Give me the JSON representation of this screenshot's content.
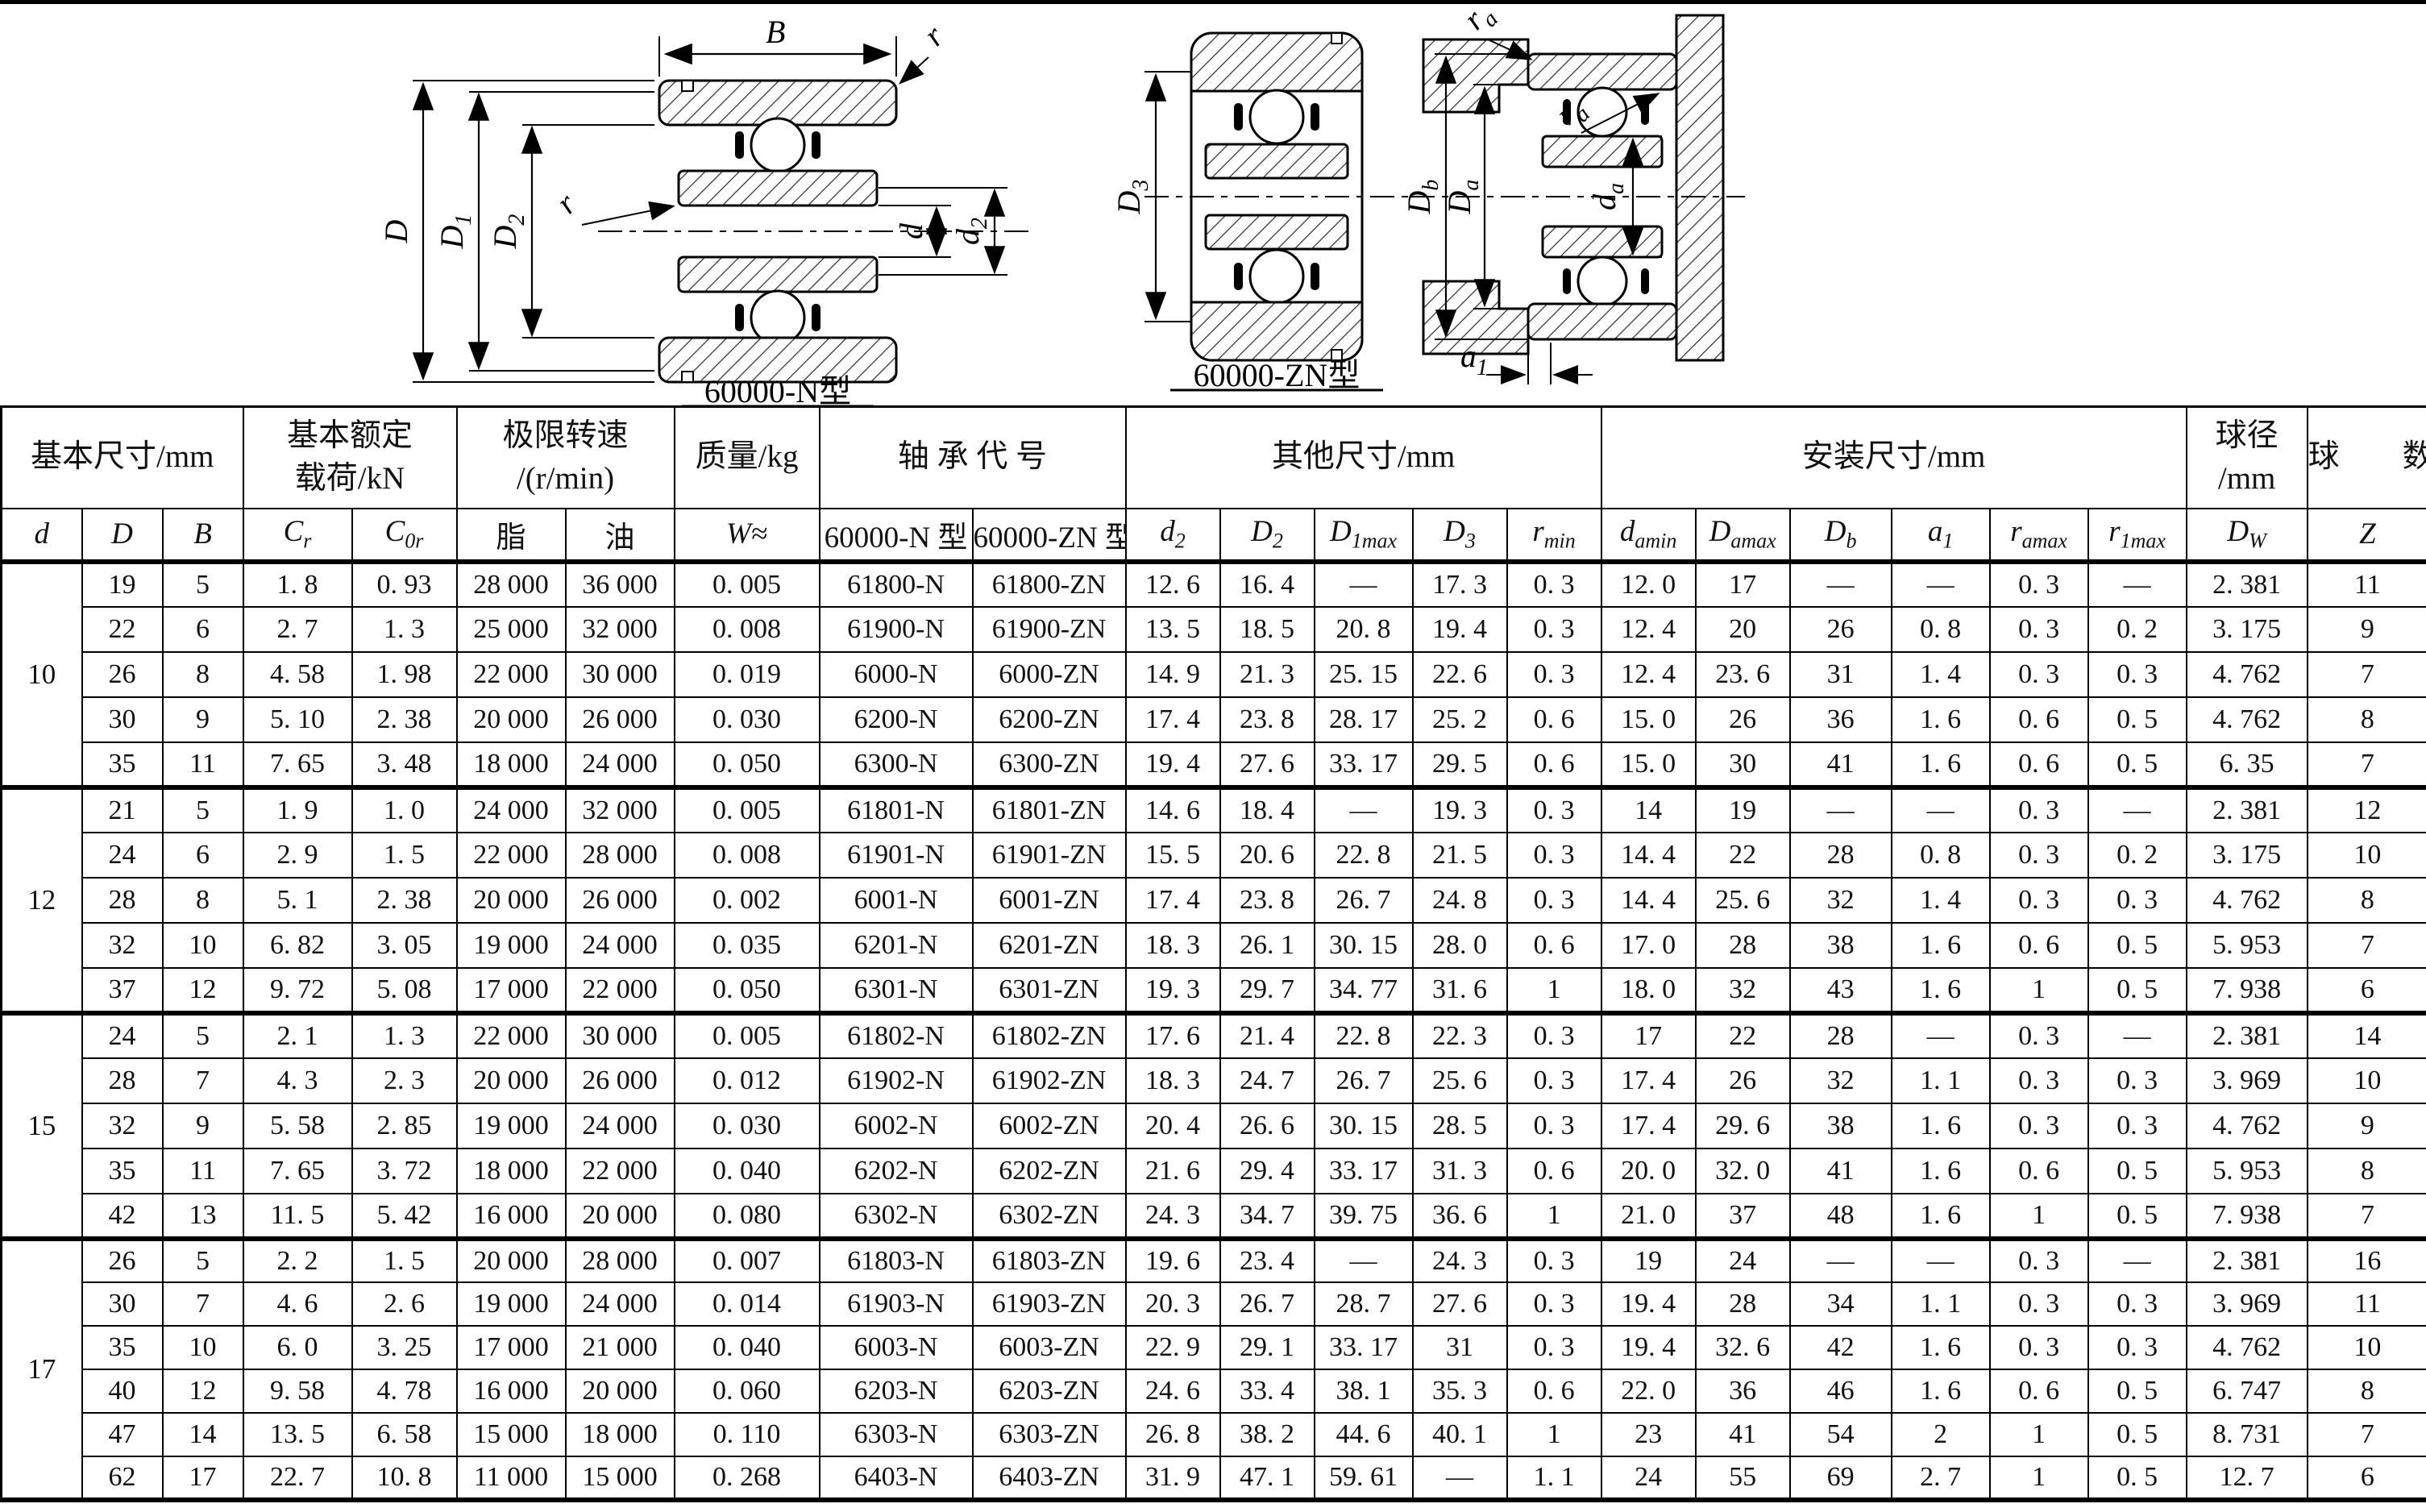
{
  "diagrams": {
    "n": {
      "label": "60000-N型",
      "B": "B",
      "r": "r",
      "D": {
        "m": "D",
        "s": ""
      },
      "D1": {
        "m": "D",
        "s": "1"
      },
      "D2": {
        "m": "D",
        "s": "2"
      },
      "d": {
        "m": "d",
        "s": ""
      },
      "d2": {
        "m": "d",
        "s": "2"
      }
    },
    "zn": {
      "label": "60000-ZN型",
      "D3": {
        "m": "D",
        "s": "3"
      }
    },
    "mount": {
      "Db": {
        "m": "D",
        "s": "b"
      },
      "Da": {
        "m": "D",
        "s": "a"
      },
      "da": {
        "m": "d",
        "s": "a"
      },
      "a1": {
        "m": "a",
        "s": "1"
      },
      "ra": {
        "m": "r",
        "s": "a"
      }
    }
  },
  "table": {
    "group_headers": [
      {
        "lines": [
          "基本尺寸/mm"
        ],
        "colspan": 3
      },
      {
        "lines": [
          "基本额定",
          "载荷/kN"
        ],
        "colspan": 2
      },
      {
        "lines": [
          "极限转速",
          "/(r/min)"
        ],
        "colspan": 2
      },
      {
        "lines": [
          "质量/kg"
        ],
        "colspan": 1
      },
      {
        "lines": [
          "轴 承 代 号"
        ],
        "colspan": 2
      },
      {
        "lines": [
          "其他尺寸/mm"
        ],
        "colspan": 5
      },
      {
        "lines": [
          "安装尺寸/mm"
        ],
        "colspan": 6
      },
      {
        "lines": [
          "球径",
          "/mm"
        ],
        "colspan": 1
      },
      {
        "lines": [
          "球　　数"
        ],
        "colspan": 1
      }
    ],
    "sub_headers": [
      {
        "m": "d",
        "it": true
      },
      {
        "m": "D",
        "it": true
      },
      {
        "m": "B",
        "it": true
      },
      {
        "m": "C",
        "s": "r",
        "it": true
      },
      {
        "m": "C",
        "s": "0r",
        "it": true
      },
      {
        "m": "脂"
      },
      {
        "m": "油"
      },
      {
        "m": "W≈",
        "it": true
      },
      {
        "m": "60000-N 型"
      },
      {
        "m": "60000-ZN 型"
      },
      {
        "m": "d",
        "s": "2",
        "it": true
      },
      {
        "m": "D",
        "s": "2",
        "it": true
      },
      {
        "m": "D",
        "s": "1max",
        "it": true
      },
      {
        "m": "D",
        "s": "3",
        "it": true
      },
      {
        "m": "r",
        "s": "min",
        "it": true
      },
      {
        "m": "d",
        "s": "amin",
        "it": true
      },
      {
        "m": "D",
        "s": "amax",
        "it": true
      },
      {
        "m": "D",
        "s": "b",
        "it": true
      },
      {
        "m": "a",
        "s": "1",
        "it": true
      },
      {
        "m": "r",
        "s": "amax",
        "it": true
      },
      {
        "m": "r",
        "s": "1max",
        "it": true
      },
      {
        "m": "D",
        "s": "W",
        "it": true
      },
      {
        "m": "Z",
        "it": true
      }
    ],
    "groups": [
      {
        "d": "10",
        "rows": [
          [
            "19",
            "5",
            "1. 8",
            "0. 93",
            "28 000",
            "36 000",
            "0. 005",
            "61800-N",
            "61800-ZN",
            "12. 6",
            "16. 4",
            "—",
            "17. 3",
            "0. 3",
            "12. 0",
            "17",
            "—",
            "—",
            "0. 3",
            "—",
            "2. 381",
            "11"
          ],
          [
            "22",
            "6",
            "2. 7",
            "1. 3",
            "25 000",
            "32 000",
            "0. 008",
            "61900-N",
            "61900-ZN",
            "13. 5",
            "18. 5",
            "20. 8",
            "19. 4",
            "0. 3",
            "12. 4",
            "20",
            "26",
            "0. 8",
            "0. 3",
            "0. 2",
            "3. 175",
            "9"
          ],
          [
            "26",
            "8",
            "4. 58",
            "1. 98",
            "22 000",
            "30 000",
            "0. 019",
            "6000-N",
            "6000-ZN",
            "14. 9",
            "21. 3",
            "25. 15",
            "22. 6",
            "0. 3",
            "12. 4",
            "23. 6",
            "31",
            "1. 4",
            "0. 3",
            "0. 3",
            "4. 762",
            "7"
          ],
          [
            "30",
            "9",
            "5. 10",
            "2. 38",
            "20 000",
            "26 000",
            "0. 030",
            "6200-N",
            "6200-ZN",
            "17. 4",
            "23. 8",
            "28. 17",
            "25. 2",
            "0. 6",
            "15. 0",
            "26",
            "36",
            "1. 6",
            "0. 6",
            "0. 5",
            "4. 762",
            "8"
          ],
          [
            "35",
            "11",
            "7. 65",
            "3. 48",
            "18 000",
            "24 000",
            "0. 050",
            "6300-N",
            "6300-ZN",
            "19. 4",
            "27. 6",
            "33. 17",
            "29. 5",
            "0. 6",
            "15. 0",
            "30",
            "41",
            "1. 6",
            "0. 6",
            "0. 5",
            "6. 35",
            "7"
          ]
        ]
      },
      {
        "d": "12",
        "rows": [
          [
            "21",
            "5",
            "1. 9",
            "1. 0",
            "24 000",
            "32 000",
            "0. 005",
            "61801-N",
            "61801-ZN",
            "14. 6",
            "18. 4",
            "—",
            "19. 3",
            "0. 3",
            "14",
            "19",
            "—",
            "—",
            "0. 3",
            "—",
            "2. 381",
            "12"
          ],
          [
            "24",
            "6",
            "2. 9",
            "1. 5",
            "22 000",
            "28 000",
            "0. 008",
            "61901-N",
            "61901-ZN",
            "15. 5",
            "20. 6",
            "22. 8",
            "21. 5",
            "0. 3",
            "14. 4",
            "22",
            "28",
            "0. 8",
            "0. 3",
            "0. 2",
            "3. 175",
            "10"
          ],
          [
            "28",
            "8",
            "5. 1",
            "2. 38",
            "20 000",
            "26 000",
            "0. 002",
            "6001-N",
            "6001-ZN",
            "17. 4",
            "23. 8",
            "26. 7",
            "24. 8",
            "0. 3",
            "14. 4",
            "25. 6",
            "32",
            "1. 4",
            "0. 3",
            "0. 3",
            "4. 762",
            "8"
          ],
          [
            "32",
            "10",
            "6. 82",
            "3. 05",
            "19 000",
            "24 000",
            "0. 035",
            "6201-N",
            "6201-ZN",
            "18. 3",
            "26. 1",
            "30. 15",
            "28. 0",
            "0. 6",
            "17. 0",
            "28",
            "38",
            "1. 6",
            "0. 6",
            "0. 5",
            "5. 953",
            "7"
          ],
          [
            "37",
            "12",
            "9. 72",
            "5. 08",
            "17 000",
            "22 000",
            "0. 050",
            "6301-N",
            "6301-ZN",
            "19. 3",
            "29. 7",
            "34. 77",
            "31. 6",
            "1",
            "18. 0",
            "32",
            "43",
            "1. 6",
            "1",
            "0. 5",
            "7. 938",
            "6"
          ]
        ]
      },
      {
        "d": "15",
        "rows": [
          [
            "24",
            "5",
            "2. 1",
            "1. 3",
            "22 000",
            "30 000",
            "0. 005",
            "61802-N",
            "61802-ZN",
            "17. 6",
            "21. 4",
            "22. 8",
            "22. 3",
            "0. 3",
            "17",
            "22",
            "28",
            "—",
            "0. 3",
            "—",
            "2. 381",
            "14"
          ],
          [
            "28",
            "7",
            "4. 3",
            "2. 3",
            "20 000",
            "26 000",
            "0. 012",
            "61902-N",
            "61902-ZN",
            "18. 3",
            "24. 7",
            "26. 7",
            "25. 6",
            "0. 3",
            "17. 4",
            "26",
            "32",
            "1. 1",
            "0. 3",
            "0. 3",
            "3. 969",
            "10"
          ],
          [
            "32",
            "9",
            "5. 58",
            "2. 85",
            "19 000",
            "24 000",
            "0. 030",
            "6002-N",
            "6002-ZN",
            "20. 4",
            "26. 6",
            "30. 15",
            "28. 5",
            "0. 3",
            "17. 4",
            "29. 6",
            "38",
            "1. 6",
            "0. 3",
            "0. 3",
            "4. 762",
            "9"
          ],
          [
            "35",
            "11",
            "7. 65",
            "3. 72",
            "18 000",
            "22 000",
            "0. 040",
            "6202-N",
            "6202-ZN",
            "21. 6",
            "29. 4",
            "33. 17",
            "31. 3",
            "0. 6",
            "20. 0",
            "32. 0",
            "41",
            "1. 6",
            "0. 6",
            "0. 5",
            "5. 953",
            "8"
          ],
          [
            "42",
            "13",
            "11. 5",
            "5. 42",
            "16 000",
            "20 000",
            "0. 080",
            "6302-N",
            "6302-ZN",
            "24. 3",
            "34. 7",
            "39. 75",
            "36. 6",
            "1",
            "21. 0",
            "37",
            "48",
            "1. 6",
            "1",
            "0. 5",
            "7. 938",
            "7"
          ]
        ]
      },
      {
        "d": "17",
        "rows": [
          [
            "26",
            "5",
            "2. 2",
            "1. 5",
            "20 000",
            "28 000",
            "0. 007",
            "61803-N",
            "61803-ZN",
            "19. 6",
            "23. 4",
            "—",
            "24. 3",
            "0. 3",
            "19",
            "24",
            "—",
            "—",
            "0. 3",
            "—",
            "2. 381",
            "16"
          ],
          [
            "30",
            "7",
            "4. 6",
            "2. 6",
            "19 000",
            "24 000",
            "0. 014",
            "61903-N",
            "61903-ZN",
            "20. 3",
            "26. 7",
            "28. 7",
            "27. 6",
            "0. 3",
            "19. 4",
            "28",
            "34",
            "1. 1",
            "0. 3",
            "0. 3",
            "3. 969",
            "11"
          ],
          [
            "35",
            "10",
            "6. 0",
            "3. 25",
            "17 000",
            "21 000",
            "0. 040",
            "6003-N",
            "6003-ZN",
            "22. 9",
            "29. 1",
            "33. 17",
            "31",
            "0. 3",
            "19. 4",
            "32. 6",
            "42",
            "1. 6",
            "0. 3",
            "0. 3",
            "4. 762",
            "10"
          ],
          [
            "40",
            "12",
            "9. 58",
            "4. 78",
            "16 000",
            "20 000",
            "0. 060",
            "6203-N",
            "6203-ZN",
            "24. 6",
            "33. 4",
            "38. 1",
            "35. 3",
            "0. 6",
            "22. 0",
            "36",
            "46",
            "1. 6",
            "0. 6",
            "0. 5",
            "6. 747",
            "8"
          ],
          [
            "47",
            "14",
            "13. 5",
            "6. 58",
            "15 000",
            "18 000",
            "0. 110",
            "6303-N",
            "6303-ZN",
            "26. 8",
            "38. 2",
            "44. 6",
            "40. 1",
            "1",
            "23",
            "41",
            "54",
            "2",
            "1",
            "0. 5",
            "8. 731",
            "7"
          ],
          [
            "62",
            "17",
            "22. 7",
            "10. 8",
            "11 000",
            "15 000",
            "0. 268",
            "6403-N",
            "6403-ZN",
            "31. 9",
            "47. 1",
            "59. 61",
            "—",
            "1. 1",
            "24",
            "55",
            "69",
            "2. 7",
            "1",
            "0. 5",
            "12. 7",
            "6"
          ]
        ]
      }
    ]
  }
}
